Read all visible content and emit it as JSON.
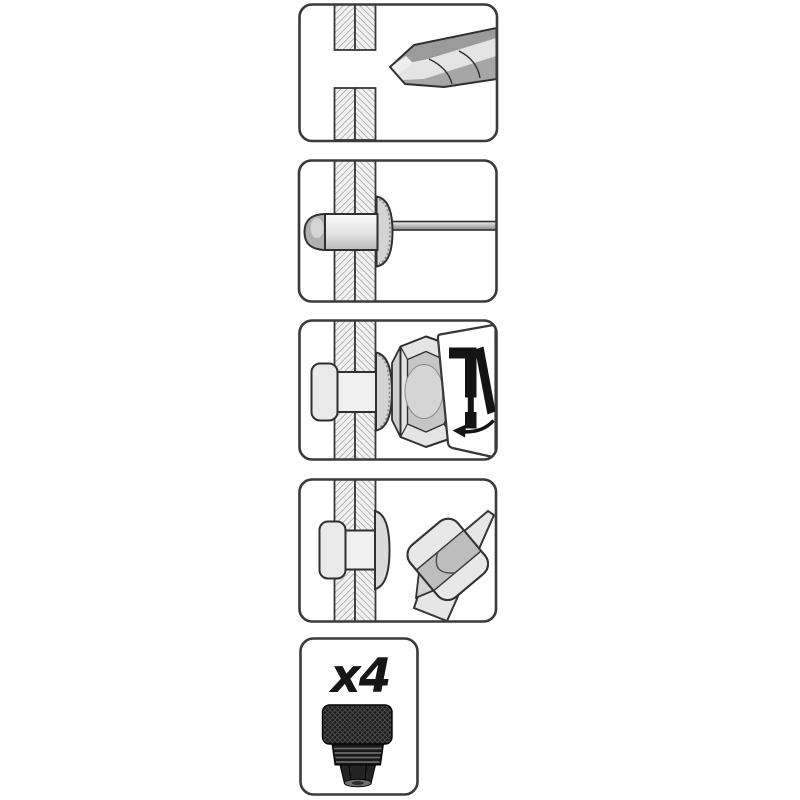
{
  "canvas": {
    "width": 800,
    "height": 800,
    "background": "#ffffff"
  },
  "colors": {
    "panel_border": "#3a3a3a",
    "panel_fill": "#ffffff",
    "detail_line": "#2f2f2f",
    "hatch_line": "#969696",
    "hatch_fill": "#f2f2f2",
    "metal_light": "#e8e8e8",
    "metal_mid": "#c0c0c0",
    "metal_dark": "#9a9a9a",
    "icon_black": "#141414",
    "adapter_black": "#1d1d1d"
  },
  "steps": [
    {
      "index": 1,
      "icon": "drill-bit-icon",
      "depicts": "drill hole through sheet"
    },
    {
      "index": 2,
      "icon": "rivet-nut-mandrel-icon",
      "depicts": "insert rivet nut on mandrel"
    },
    {
      "index": 3,
      "icon": "tool-nose-icon",
      "callout_icon": "hand-riveter-squeeze-icon",
      "depicts": "squeeze tool to set rivet nut"
    },
    {
      "index": 4,
      "icon": "tool-removal-icon",
      "depicts": "remove tool, rivet nut installed"
    },
    {
      "index": 5,
      "icon": "threaded-adapter-icon",
      "quantity_label": "x4",
      "depicts": "four threaded adapters included"
    }
  ]
}
